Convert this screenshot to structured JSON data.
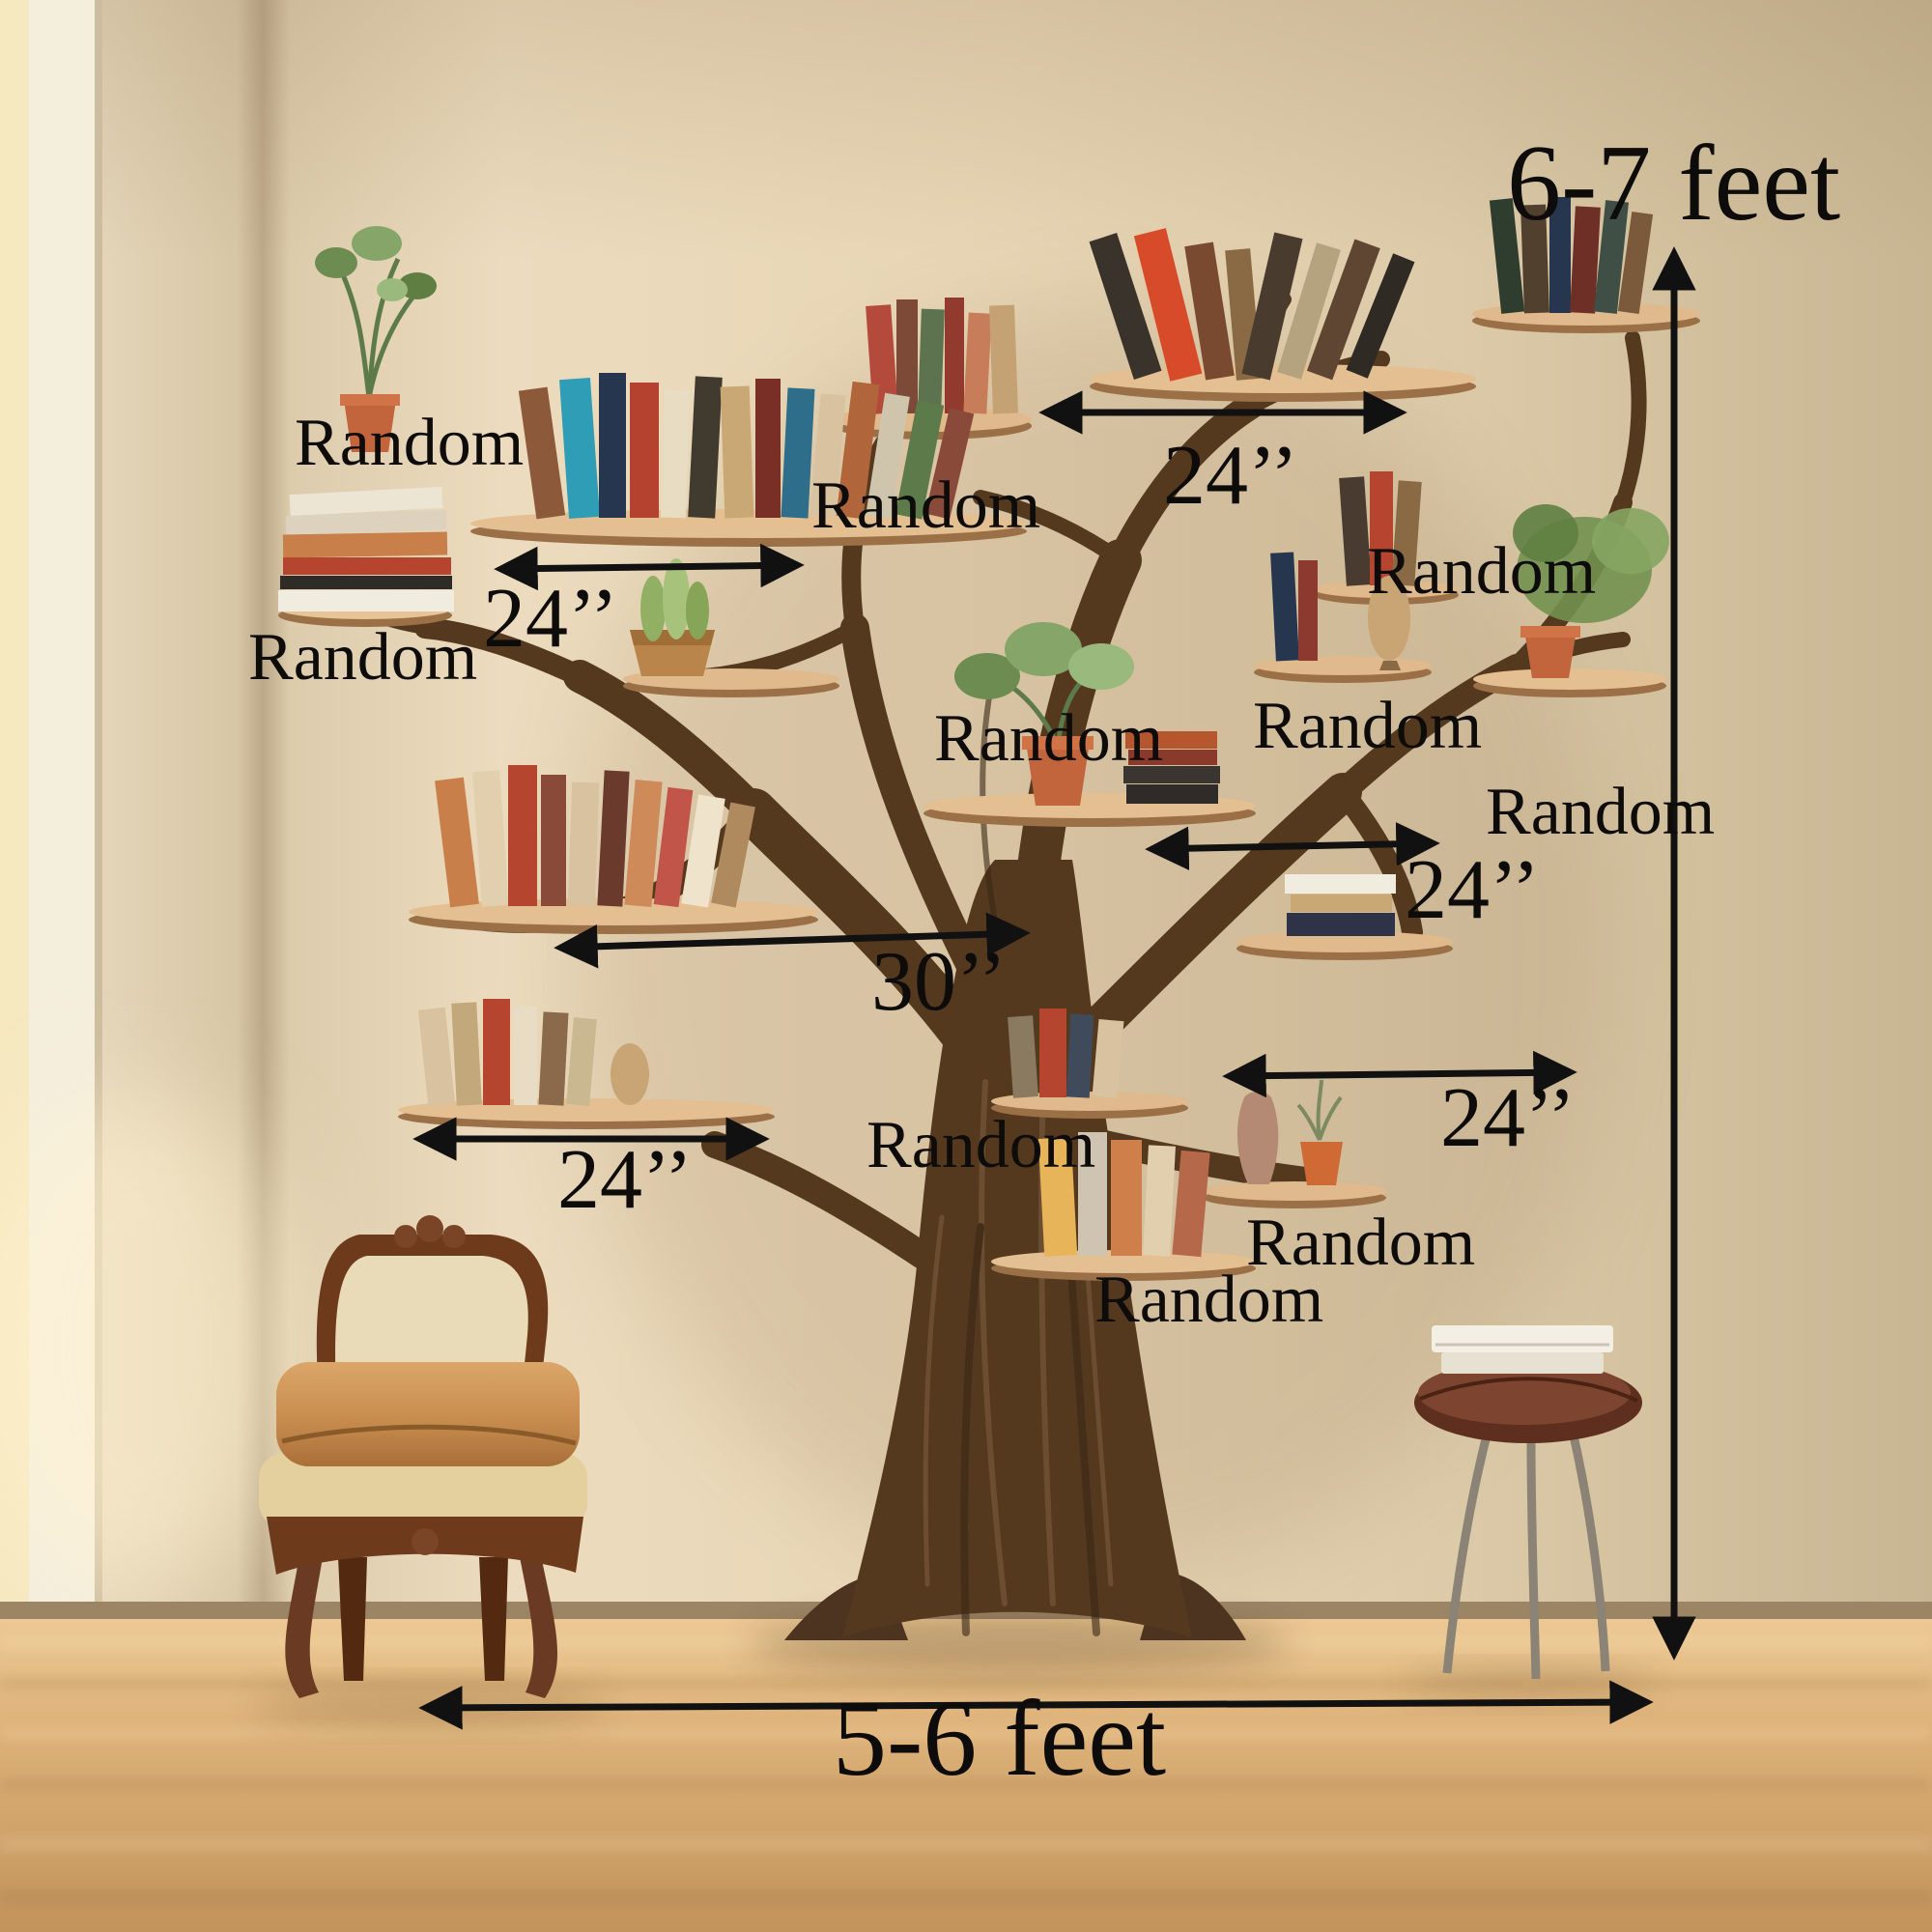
{
  "annotations": {
    "overall_height": {
      "text": "6-7 feet"
    },
    "overall_width": {
      "text": "5-6 feet"
    },
    "measurements": [
      {
        "id": "top-shelf-width",
        "text": "24’’"
      },
      {
        "id": "upper-left-shelf-width",
        "text": "24’’"
      },
      {
        "id": "middle-shelf-width",
        "text": "30’’"
      },
      {
        "id": "middle-right-shelf-width",
        "text": "24’’"
      },
      {
        "id": "lower-right-shelf-width",
        "text": "24’’"
      },
      {
        "id": "lower-left-shelf-width",
        "text": "24’’"
      }
    ],
    "random_labels": [
      {
        "id": "top-left",
        "text": "Random"
      },
      {
        "id": "top-middle",
        "text": "Random"
      },
      {
        "id": "left-middle",
        "text": "Random"
      },
      {
        "id": "center",
        "text": "Random"
      },
      {
        "id": "center-right",
        "text": "Random"
      },
      {
        "id": "right-upper",
        "text": "Random"
      },
      {
        "id": "far-right",
        "text": "Random"
      },
      {
        "id": "center-lower",
        "text": "Random"
      },
      {
        "id": "bottom-right",
        "text": "Random"
      },
      {
        "id": "bottom-center",
        "text": "Random"
      }
    ]
  },
  "colors": {
    "annotation_ink": "#111111",
    "wall": "#e4d3b4",
    "floor": "#dcb37c",
    "tree_wood": "#54391f",
    "shelf_wood": "#e0ba8c"
  }
}
